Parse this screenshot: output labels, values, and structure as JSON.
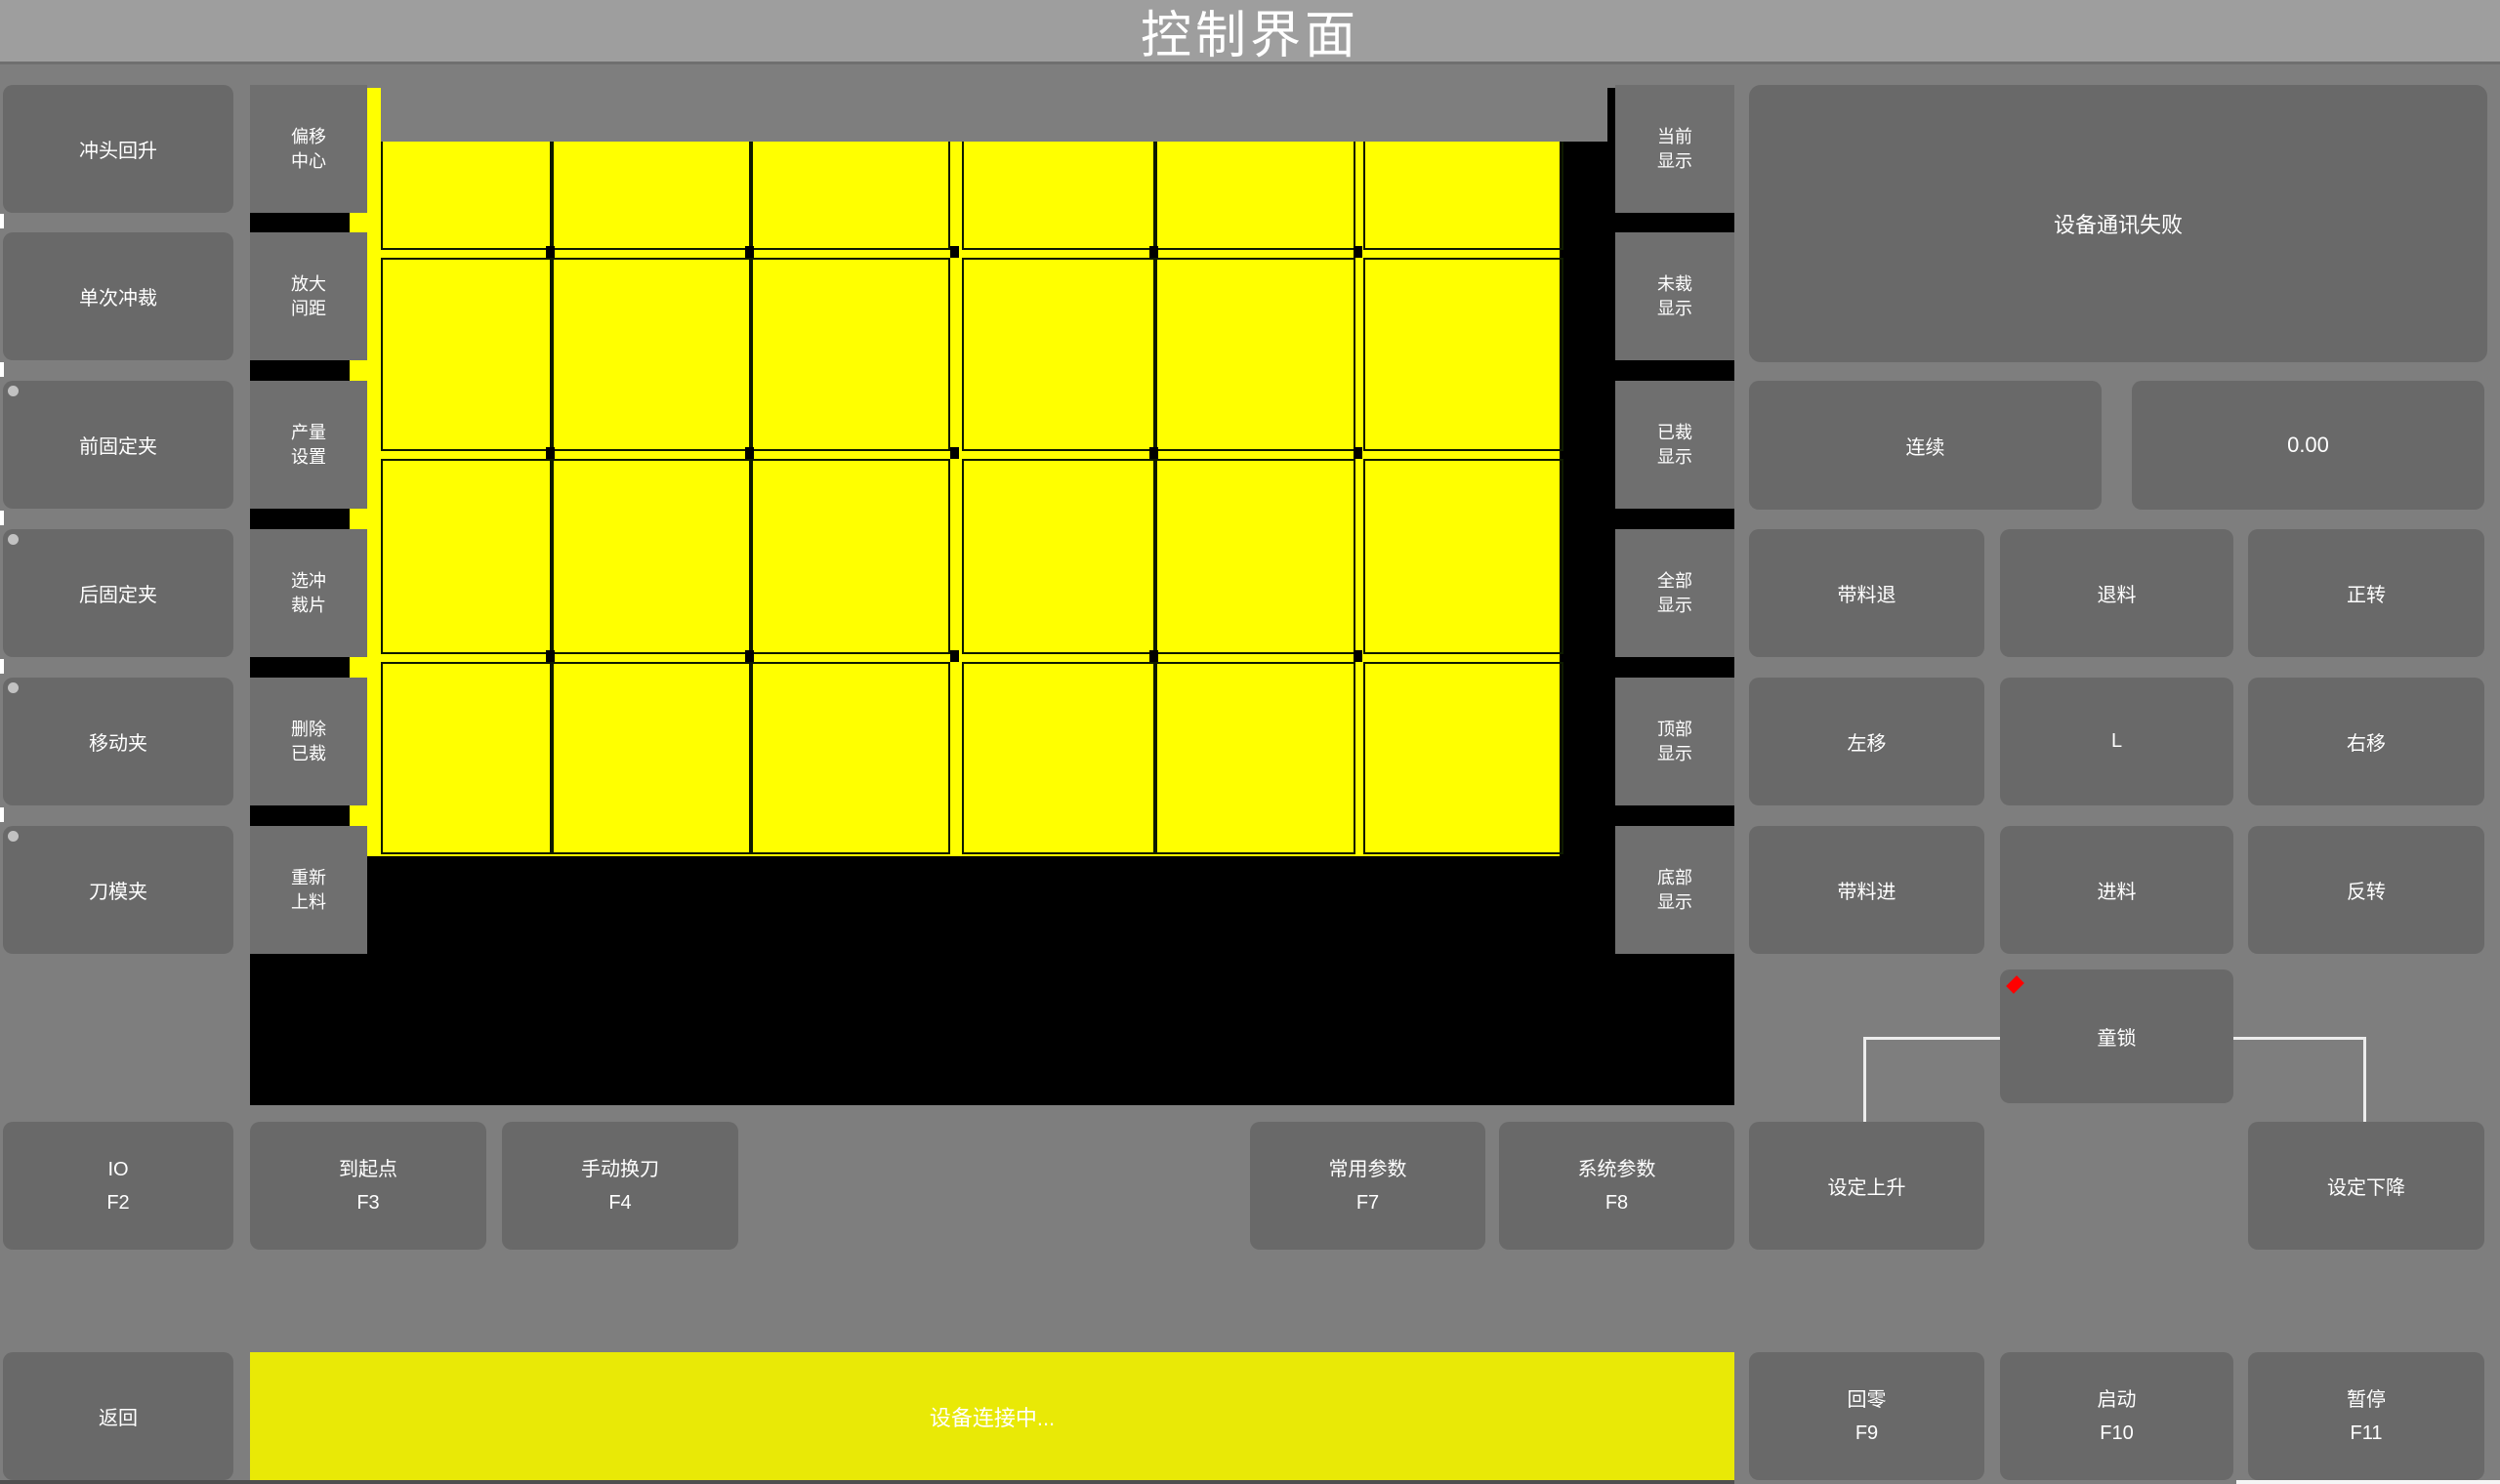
{
  "title_bar": {
    "title": "控制界面"
  },
  "left_buttons": [
    {
      "label": "冲头回升",
      "indicator": false
    },
    {
      "label": "单次冲裁",
      "indicator": false
    },
    {
      "label": "前固定夹",
      "indicator": true
    },
    {
      "label": "后固定夹",
      "indicator": true
    },
    {
      "label": "移动夹",
      "indicator": true
    },
    {
      "label": "刀模夹",
      "indicator": true
    }
  ],
  "tool_buttons": [
    [
      "偏移",
      "中心"
    ],
    [
      "放大",
      "间距"
    ],
    [
      "产量",
      "设置"
    ],
    [
      "选冲",
      "裁片"
    ],
    [
      "删除",
      "已裁"
    ],
    [
      "重新",
      "上料"
    ]
  ],
  "display_buttons": [
    [
      "当前",
      "显示"
    ],
    [
      "未裁",
      "显示"
    ],
    [
      "已裁",
      "显示"
    ],
    [
      "全部",
      "显示"
    ],
    [
      "顶部",
      "显示"
    ],
    [
      "底部",
      "显示"
    ]
  ],
  "right_panel": {
    "message": "设备通讯失败",
    "mode_button": "连续",
    "value_display": "0.00",
    "jog_grid": [
      [
        "带料退",
        "退料",
        "正转"
      ],
      [
        "左移",
        "L",
        "右移"
      ],
      [
        "带料进",
        "进料",
        "反转"
      ]
    ],
    "child_lock": "童锁"
  },
  "function_row": [
    {
      "label": "IO",
      "key": "F2"
    },
    {
      "label": "到起点",
      "key": "F3"
    },
    {
      "label": "手动换刀",
      "key": "F4"
    },
    {
      "label": "常用参数",
      "key": "F7"
    },
    {
      "label": "系统参数",
      "key": "F8"
    }
  ],
  "set_buttons": {
    "up": "设定上升",
    "down": "设定下降"
  },
  "bottom_bar": {
    "back": "返回",
    "status": "设备连接中...",
    "zero": {
      "label": "回零",
      "key": "F9"
    },
    "start": {
      "label": "启动",
      "key": "F10"
    },
    "pause": {
      "label": "暂停",
      "key": "F11"
    }
  },
  "colors": {
    "sheet_yellow": "#ffff00",
    "status_yellow": "#e9e906",
    "plot_black": "#000000",
    "button_gray": "#696969",
    "background_gray": "#7e7e7e",
    "titlebar_gray": "#9e9e9e",
    "alarm_red": "#ff0000"
  },
  "chart_data": {
    "type": "table",
    "title": "cut-piece layout preview",
    "grid": {
      "columns": 6,
      "rows": 4,
      "piece_state": "uncut",
      "piece_color": "#ffff00"
    }
  },
  "sheet": {
    "columns_x": [
      [
        390,
        561
      ],
      [
        565,
        765
      ],
      [
        769,
        969
      ],
      [
        985,
        1179
      ],
      [
        1183,
        1384
      ],
      [
        1396,
        1597
      ]
    ],
    "rows_y": [
      [
        98,
        252
      ],
      [
        264,
        458
      ],
      [
        470,
        666
      ],
      [
        678,
        871
      ]
    ],
    "notch_xs": [
      563,
      767,
      977,
      1181,
      1390
    ],
    "notch_ys": [
      252,
      458,
      666
    ]
  }
}
